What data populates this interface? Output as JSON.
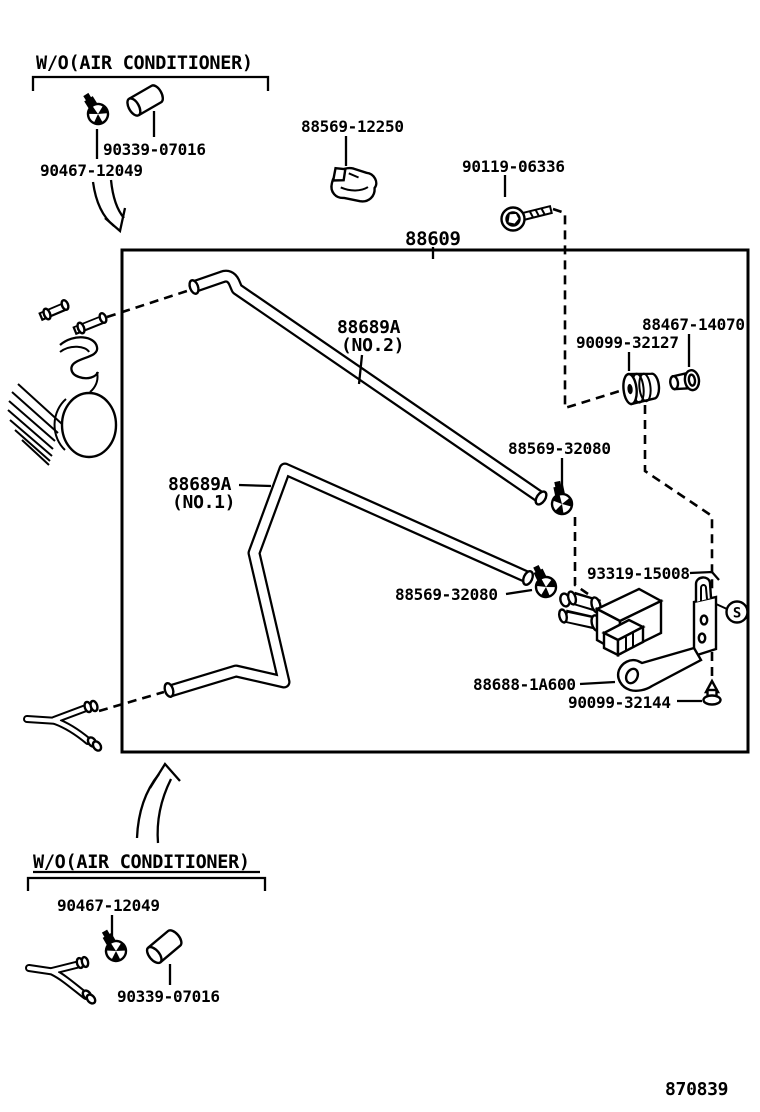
{
  "canvas": {
    "bg": "#ffffff",
    "ink": "#000000"
  },
  "variant_top": {
    "title": "W/O(AIR CONDITIONER)",
    "clamp": "90467-12049",
    "cap": "90339-07016"
  },
  "main_assembly": {
    "number": "88609",
    "clip": "88569-12250",
    "bolt": "90119-06336",
    "hose2": {
      "line1": "88689A",
      "line2": "(NO.2)"
    },
    "hose1": {
      "line1": "88689A",
      "line2": "(NO.1)"
    },
    "grommet": "90099-32127",
    "bushing": "88467-14070",
    "clamp_upper": "88569-32080",
    "clamp_lower": "88569-32080",
    "valve": "93319-15008",
    "bracket": "88688-1A600",
    "screw": "90099-32144",
    "screw_symbol": "S"
  },
  "variant_bottom": {
    "title": "W/O(AIR CONDITIONER)",
    "clamp": "90467-12049",
    "cap": "90339-07016"
  },
  "footer": {
    "drawing_number": "870839"
  }
}
